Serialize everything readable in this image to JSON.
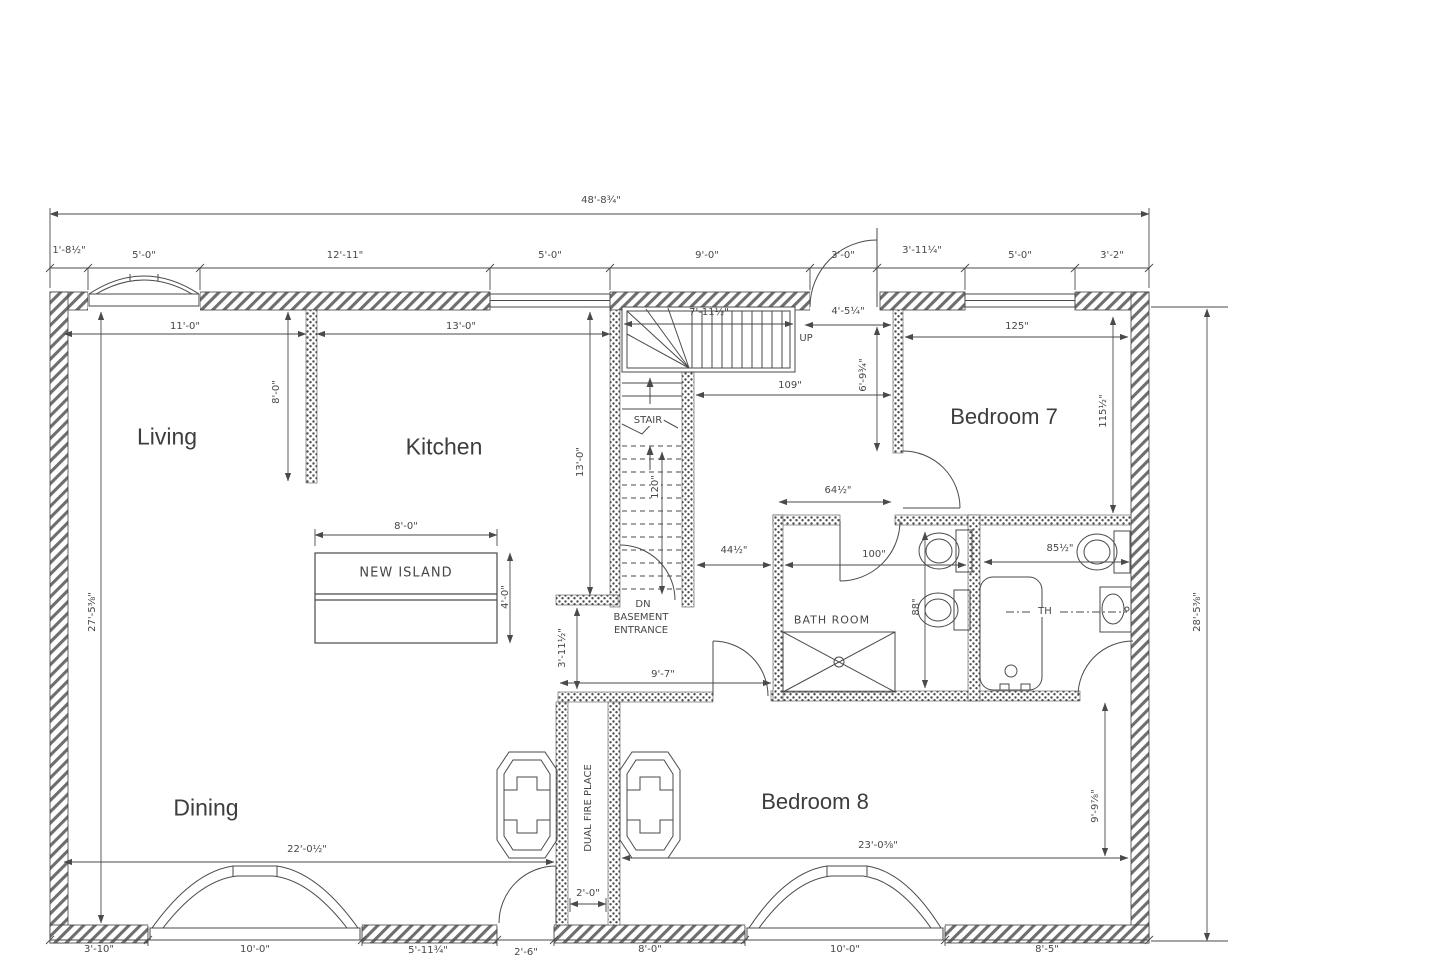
{
  "rooms": {
    "living": "Living",
    "kitchen": "Kitchen",
    "bedroom7": "Bedroom 7",
    "dining": "Dining",
    "bedroom8": "Bedroom 8",
    "bathroom": "BATH ROOM",
    "new_island": "NEW ISLAND",
    "stair": "STAIR",
    "up": "UP",
    "dn": "DN",
    "basement": "BASEMENT",
    "entrance": "ENTRANCE",
    "dual_fireplace": "DUAL FIRE PLACE",
    "towel": "TH"
  },
  "dims": {
    "overall_width": "48'-8¾\"",
    "top_row": [
      "1'-8½\"",
      "5'-0\"",
      "12'-11\"",
      "5'-0\"",
      "9'-0\"",
      "3'-0\"",
      "3'-11¼\"",
      "5'-0\"",
      "3'-2\""
    ],
    "bottom_row": [
      "3'-10\"",
      "10'-0\"",
      "5'-11¾\"",
      "2'-6\"",
      "8'-0\"",
      "10'-0\"",
      "8'-5\""
    ],
    "left_height": "27'-5⅜\"",
    "right_height": "28'-5⅜\"",
    "living_width": "11'-0\"",
    "kitchen_width": "13'-0\"",
    "living_wall": "8'-0\"",
    "stair_width": "7'-11½\"",
    "stair_height": "13'-0\"",
    "stair_run": "120\"",
    "hall_entry": "4'-5¼\"",
    "hall_depth": "6'-9¾\"",
    "hall_width": "109\"",
    "hall_bath": "64½\"",
    "hall_lower": "44½\"",
    "bath_width": "100\"",
    "bath_height": "88\"",
    "tub_room_width": "85½\"",
    "bedroom7_width": "125\"",
    "bedroom7_height": "115½\"",
    "hall_bottom": "9'-7\"",
    "hall_opening": "3'-11½\"",
    "island_width": "8'-0\"",
    "island_depth": "4'-0\"",
    "dining_width": "22'-0½\"",
    "bedroom8_width": "23'-0⅜\"",
    "bedroom8_height": "9'-9⅞\"",
    "fireplace_width": "2'-0\""
  }
}
